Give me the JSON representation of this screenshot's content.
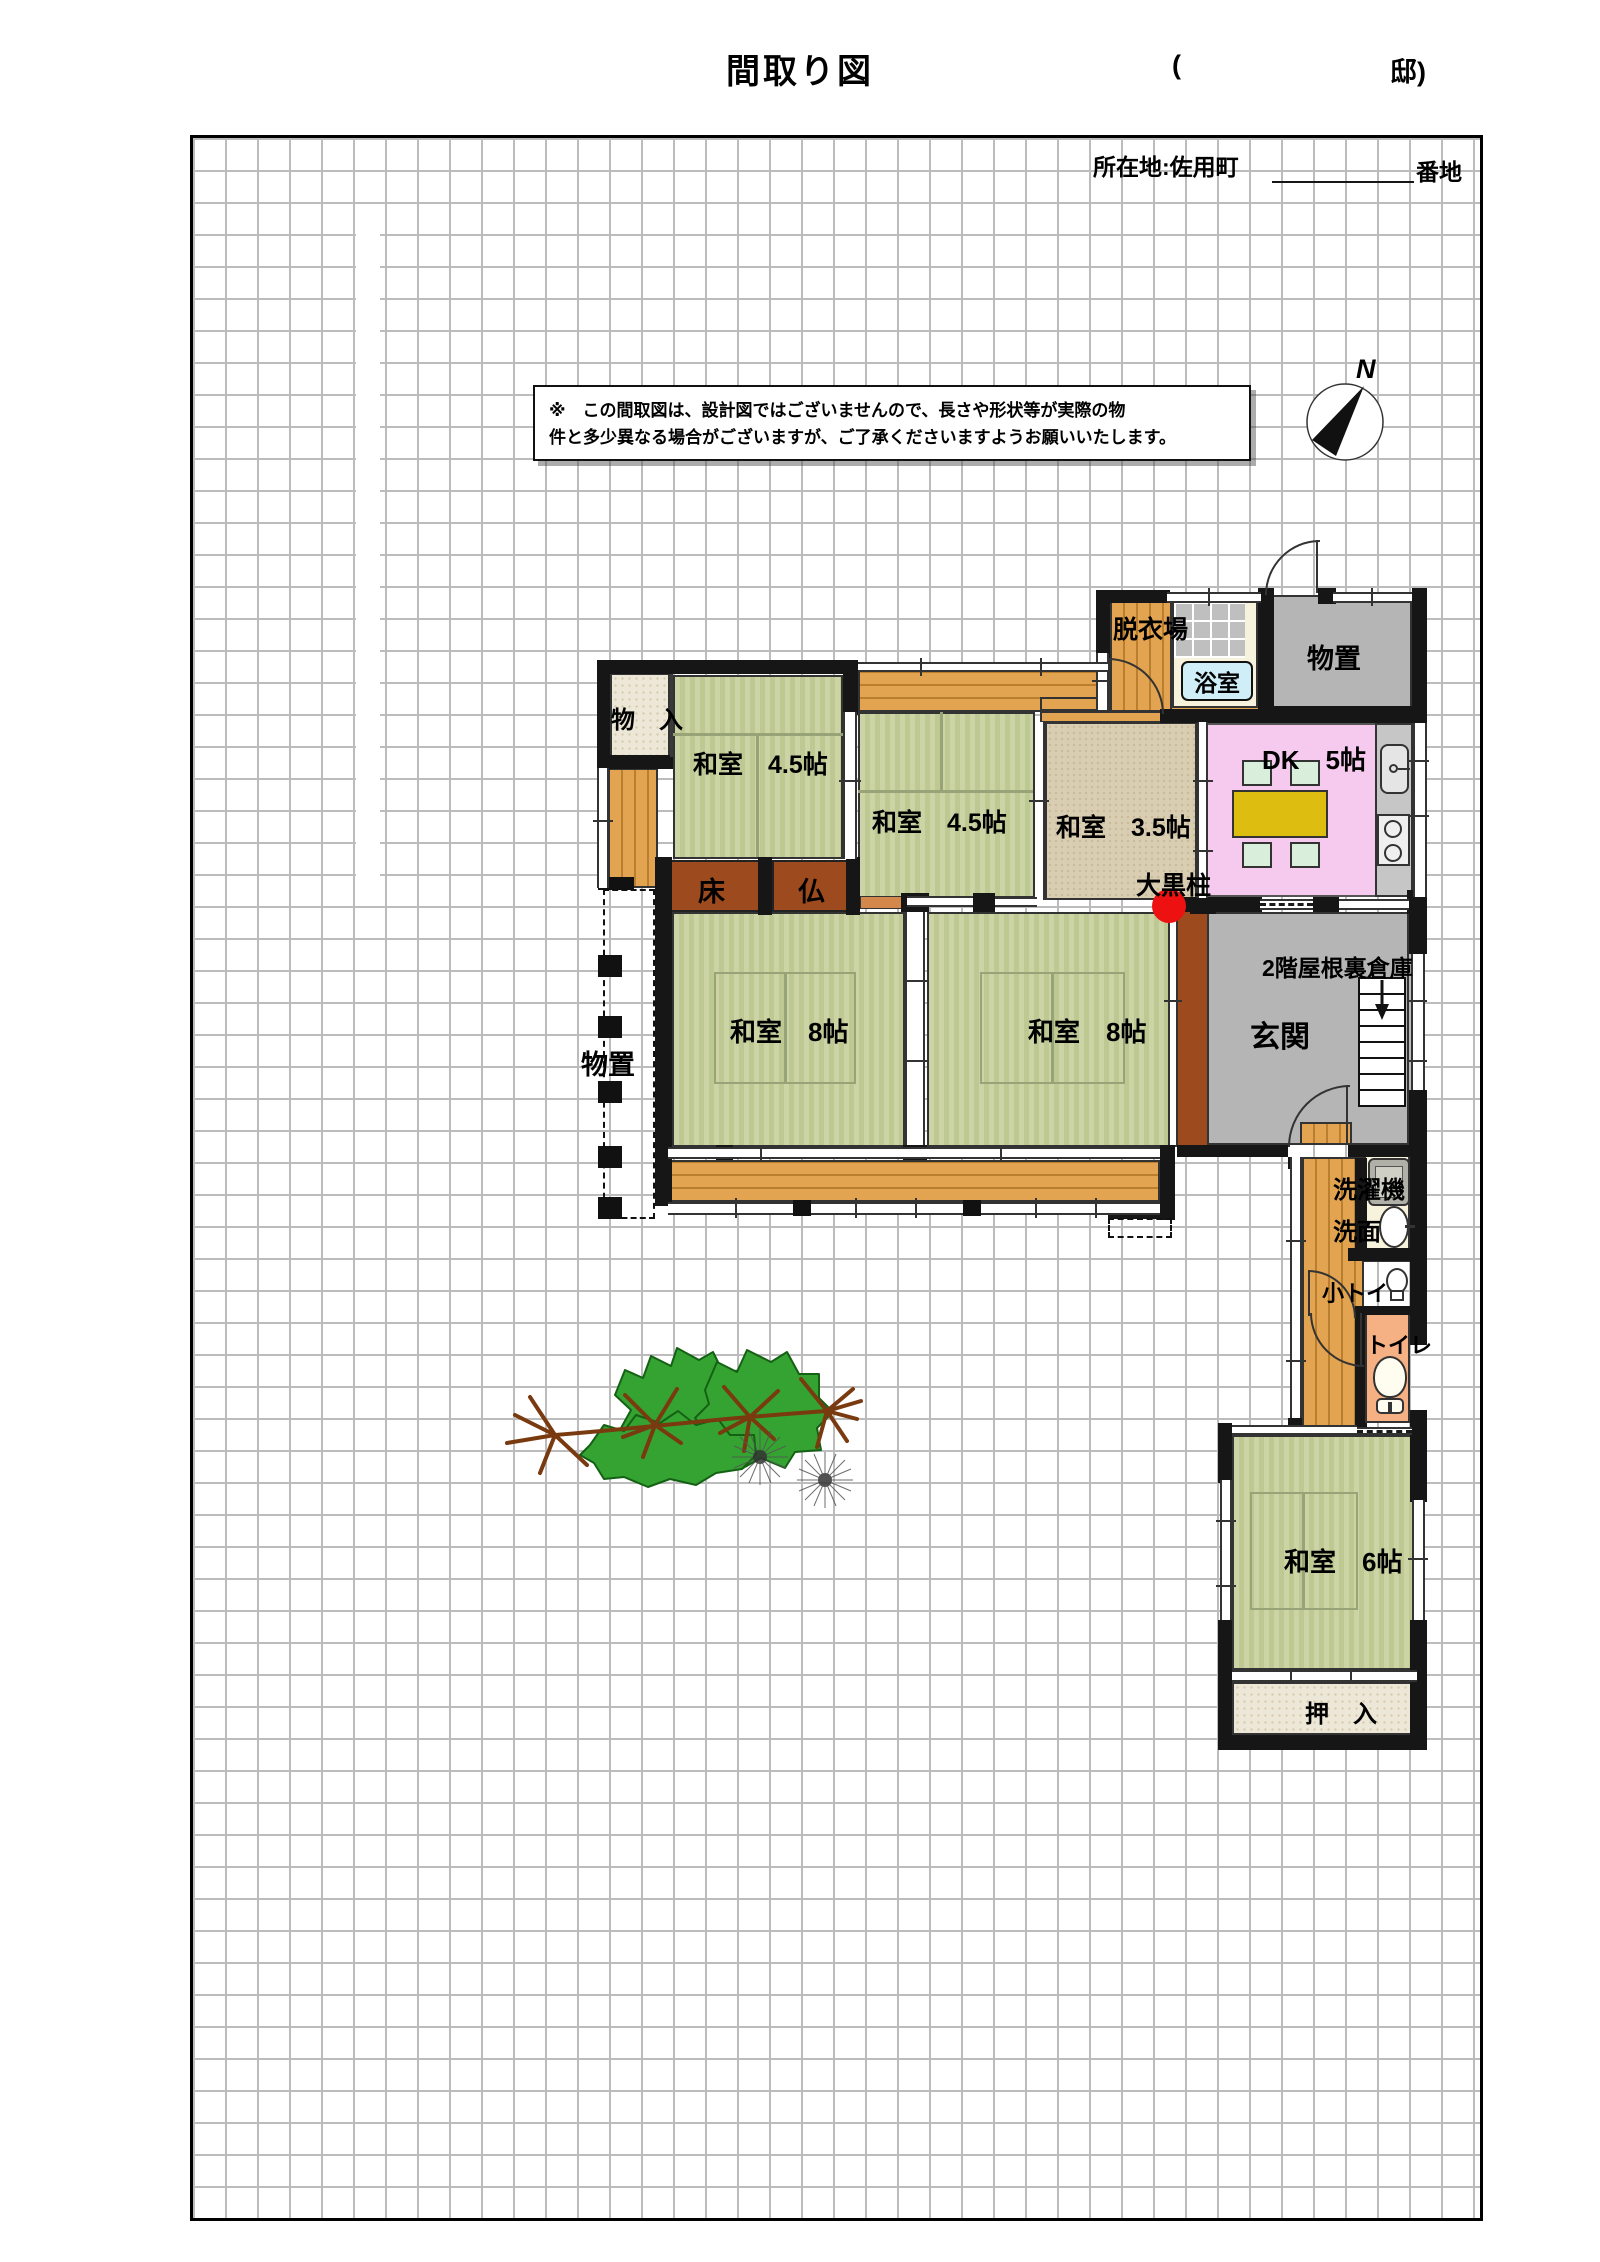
{
  "header": {
    "title": "間取り図",
    "owner_open": "(",
    "owner_close": "邸)",
    "location": "所在地:佐用町",
    "banchi": "番地"
  },
  "disclaimer": {
    "line1": "※　この間取図は、設計図ではございませんので、長さや形状等が実際の物",
    "line2": "件と多少異なる場合がございますが、ご了承くださいますようお願いいたします。"
  },
  "compass": {
    "north": "N"
  },
  "rooms": {
    "monoire": "物　入",
    "washitsu45_a": "和室　4.5帖",
    "washitsu45_b": "和室　4.5帖",
    "washitsu35": "和室　3.5帖",
    "datsuijo": "脱衣場",
    "yokushitsu": "浴室",
    "monooki_top": "物置",
    "dk": "DK　5帖",
    "daikokubashira": "大黒柱",
    "tokonoma": "床",
    "butsudan": "仏",
    "washitsu8_a": "和室　8帖",
    "washitsu8_b": "和室　8帖",
    "genkan": "玄関",
    "attic": "2階屋根裏倉庫",
    "monooki_left": "物置",
    "sentakuki": "洗濯機",
    "senmen": "洗面",
    "kotoilet": "小トイ",
    "toilet": "トイレ",
    "washitsu6": "和室　6帖",
    "oshiire": "押　入"
  },
  "colors": {
    "tatami_green": "#ccd3a4",
    "tatami35_beige": "#d9cdb2",
    "wood_orange": "#e3a451",
    "dk_pink": "#f6c9ef",
    "storage_gray": "#b5b5b5",
    "tokonoma_brown": "#9c4a1e",
    "toilet_salmon": "#f5b184",
    "bath_cream": "#f7f2dc",
    "bath_label_bg": "#cfeef8",
    "pillar_red": "#ee1111",
    "table_yellow": "#ddbe10",
    "chair_green": "#d9efdc",
    "grid_gray": "#bcbcbc"
  }
}
